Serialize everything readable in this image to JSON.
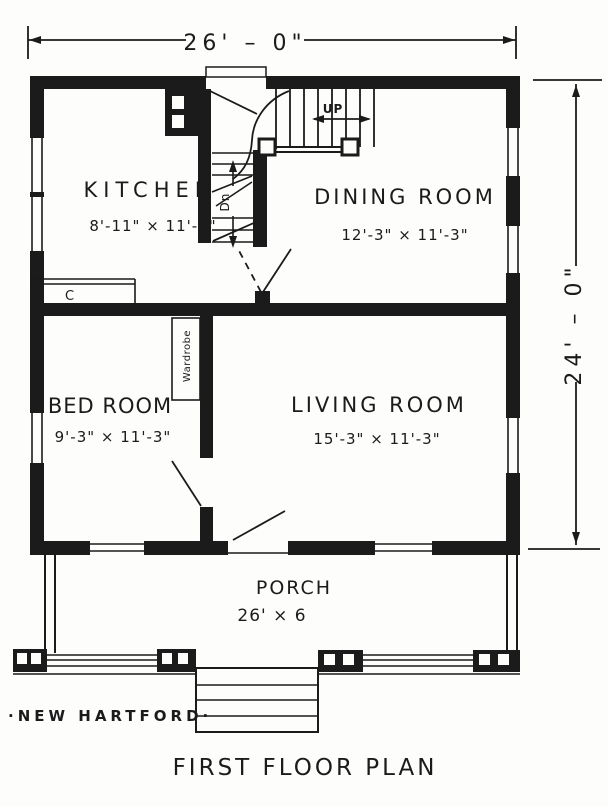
{
  "plan": {
    "title": "FIRST FLOOR PLAN",
    "caption": "·NEW HARTFORD·",
    "overall_dimensions": {
      "width": "26' – 0\"",
      "height": "24' – 0\""
    },
    "rooms": {
      "kitchen": {
        "name": "KITCHEN",
        "size": "8'-11\" × 11'-3\""
      },
      "dining": {
        "name": "DINING ROOM",
        "size": "12'-3\" × 11'-3\""
      },
      "bedroom": {
        "name": "BED ROOM",
        "size": "9'-3\" × 11'-3\""
      },
      "living": {
        "name": "LIVING ROOM",
        "size": "15'-3\" × 11'-3\""
      },
      "porch": {
        "name": "PORCH",
        "size": "26' × 6"
      }
    },
    "annotations": {
      "stairs_up": "UP",
      "stairs_down": "Dn",
      "wardrobe": "Wardrobe",
      "cupboard": "C"
    },
    "colors": {
      "ink": "#1b1b1b",
      "paper": "#fdfdfc"
    }
  }
}
